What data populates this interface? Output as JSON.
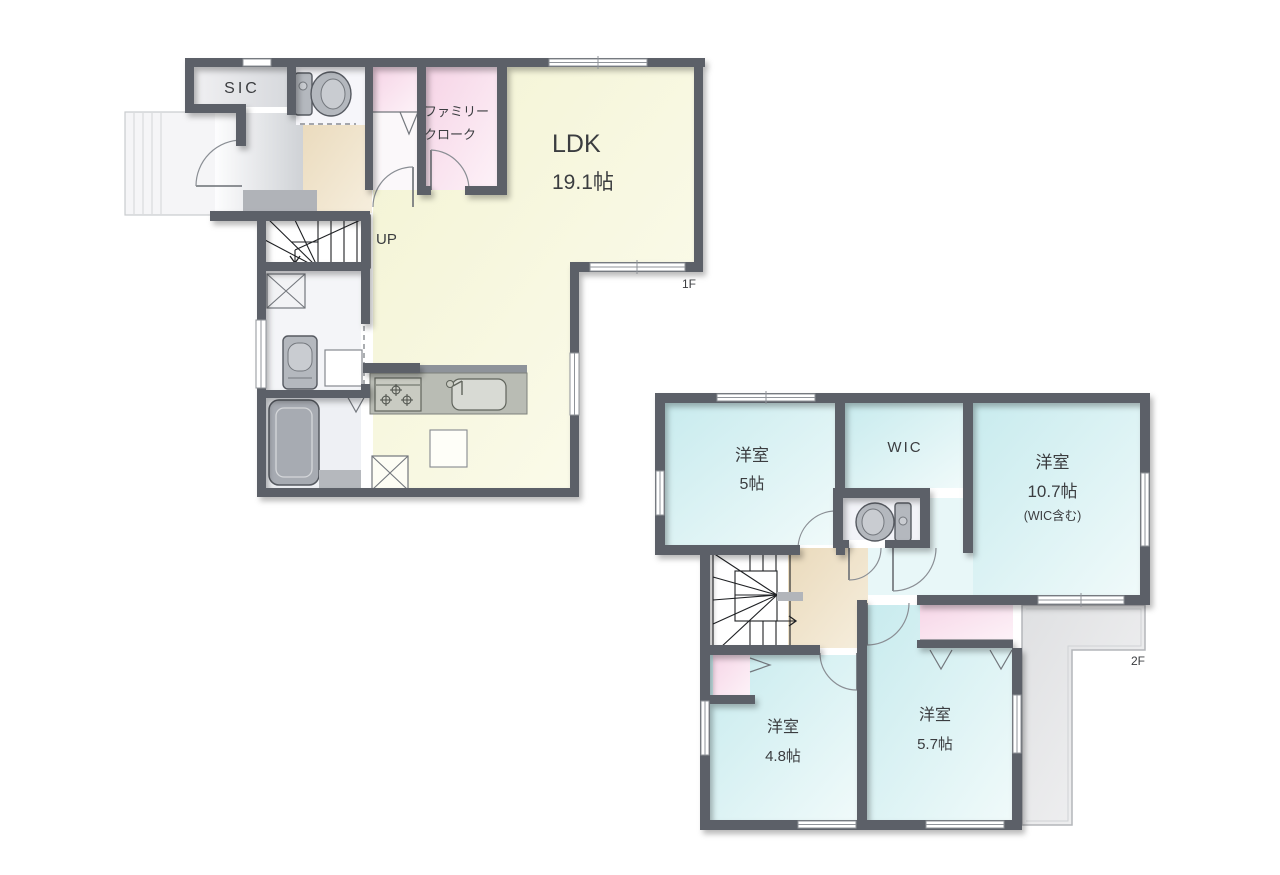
{
  "page": {
    "type": "floor-plan"
  },
  "floor1": {
    "label": "1F",
    "sic": "SIC",
    "family_cloak": {
      "line1": "ファミリー",
      "line2": "クローク"
    },
    "ldk": {
      "name": "LDK",
      "size": "19.1帖"
    },
    "stairs": "UP"
  },
  "floor2": {
    "label": "2F",
    "bedroom_5": {
      "name": "洋室",
      "size": "5帖"
    },
    "wic": "WIC",
    "bedroom_107": {
      "name": "洋室",
      "size": "10.7帖",
      "note": "(WIC含む)"
    },
    "bedroom_48": {
      "name": "洋室",
      "size": "4.8帖"
    },
    "bedroom_57": {
      "name": "洋室",
      "size": "5.7帖"
    }
  },
  "colors": {
    "wall": "#5c6168",
    "ldk_floor": "#f6f6dc",
    "bedroom_floor": "#cfeef1",
    "closet_pink": "#f7d9e9",
    "hall_beige": "#ecdcc1",
    "balcony_gray": "#e8e9ea",
    "fixture_gray": "#b4b7bd"
  }
}
